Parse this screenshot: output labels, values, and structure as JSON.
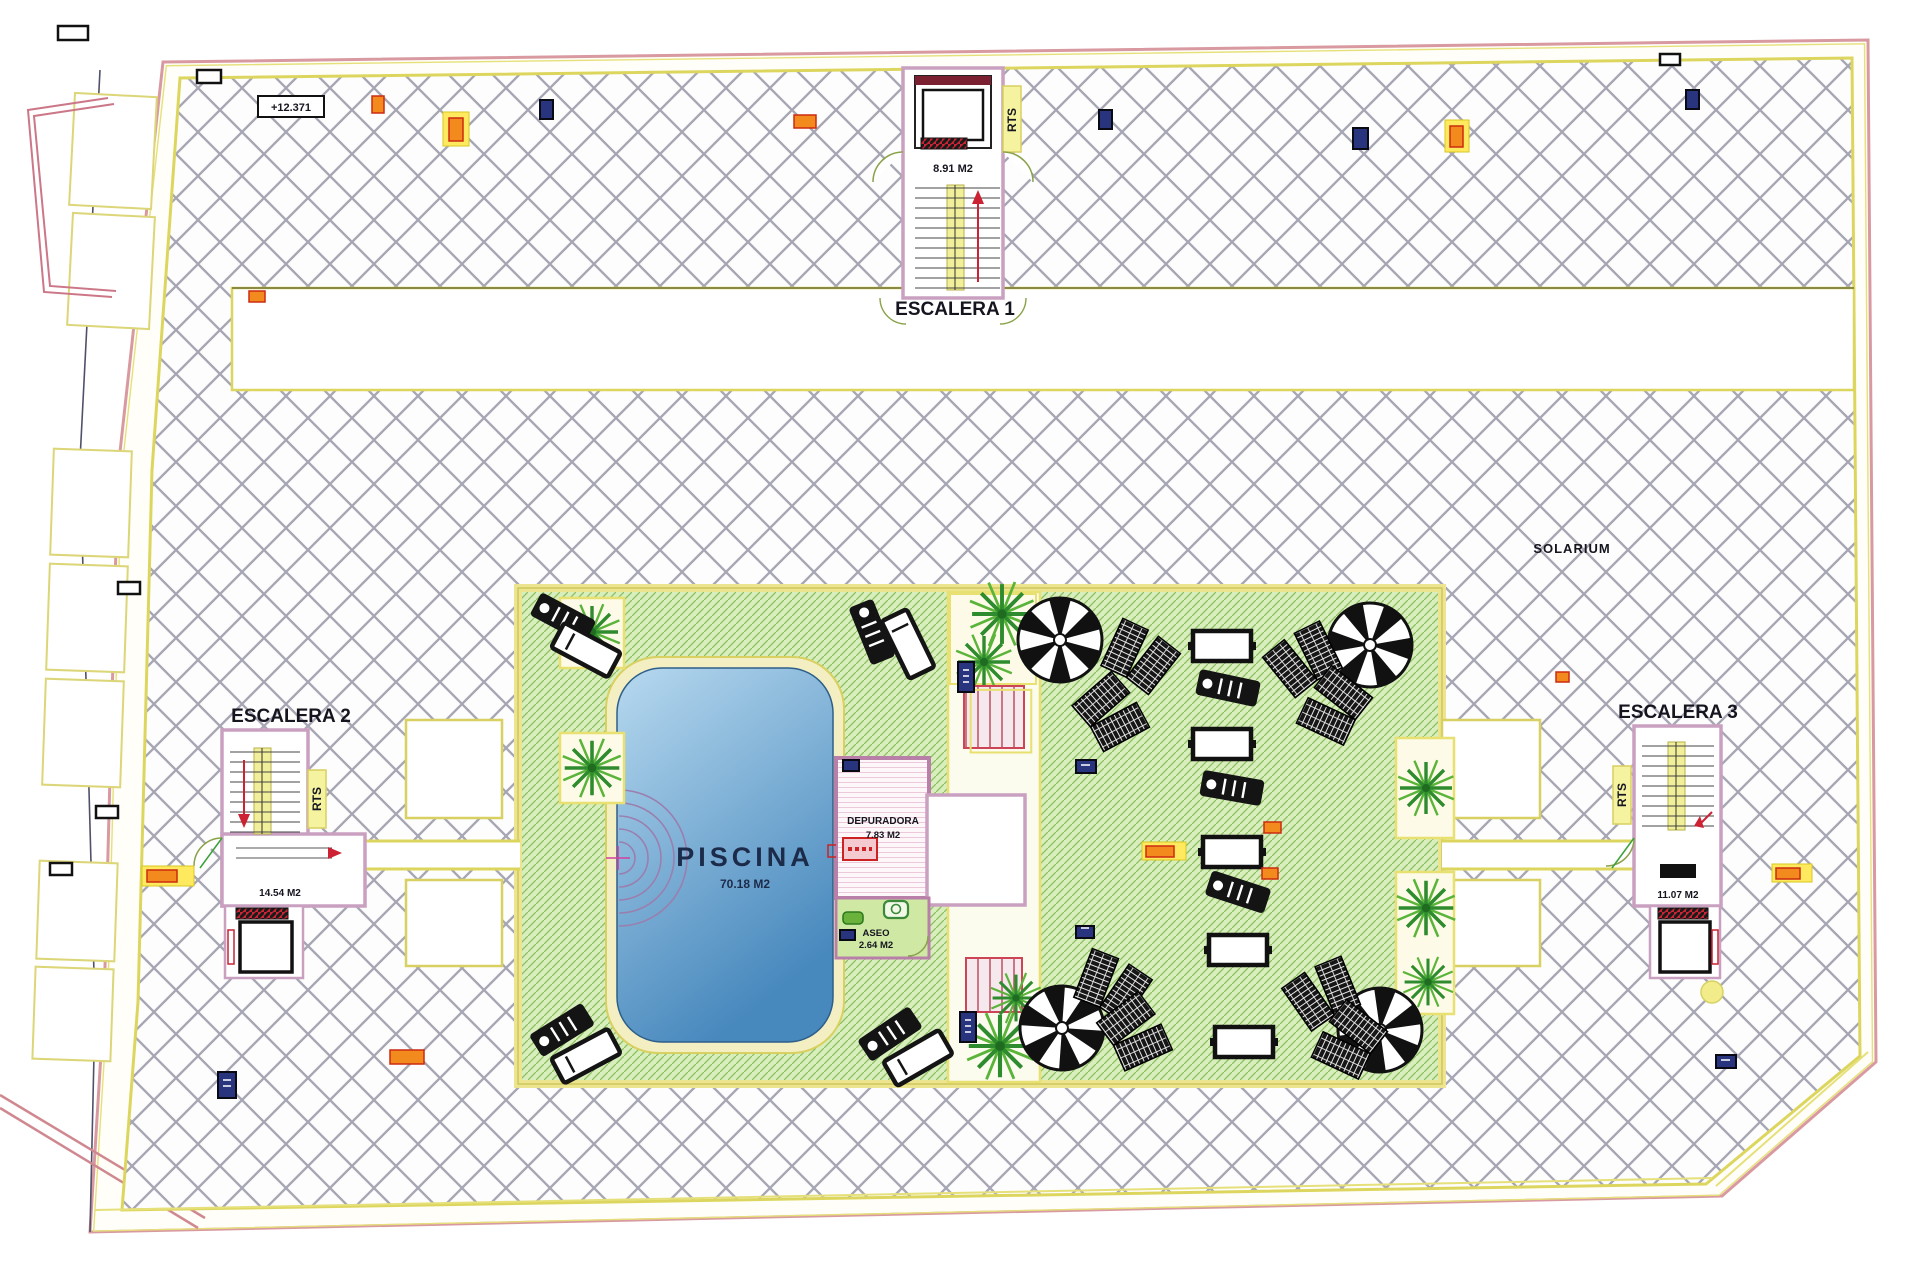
{
  "plan": {
    "labels": {
      "stair1_title": "ESCALERA 1",
      "stair2_title": "ESCALERA 2",
      "stair3_title": "ESCALERA 3",
      "solarium": "SOLARIUM",
      "pool_name": "PISCINA",
      "pool_area": "70.18 M2",
      "plant_room_name": "DEPURADORA",
      "plant_room_area": "7.83 M2",
      "wc_name": "ASEO",
      "wc_area": "2.64 M2",
      "stair1_area": "8.91 M2",
      "stair2_area": "14.54 M2",
      "stair3_area": "11.07 M2",
      "riser_tag": "RTS",
      "level_mark": "+12.371"
    },
    "colors": {
      "deck_hatch_line": "#a6a6b4",
      "lawn_fill": "#d9eebd",
      "lawn_hatch_line": "#8cc060",
      "pool_light": "#b7d9ef",
      "pool_dark": "#4788bd",
      "wall_pink": "#bb86ad",
      "stair_yellow": "#f2ef9a",
      "border_yellow": "#ddd65e",
      "boundary_pink": "#d89aa0",
      "accent_red": "#cc2233",
      "marker_orange": "#f28a1e",
      "marker_blue": "#28357e",
      "palm_green": "#2e8b2e"
    }
  }
}
